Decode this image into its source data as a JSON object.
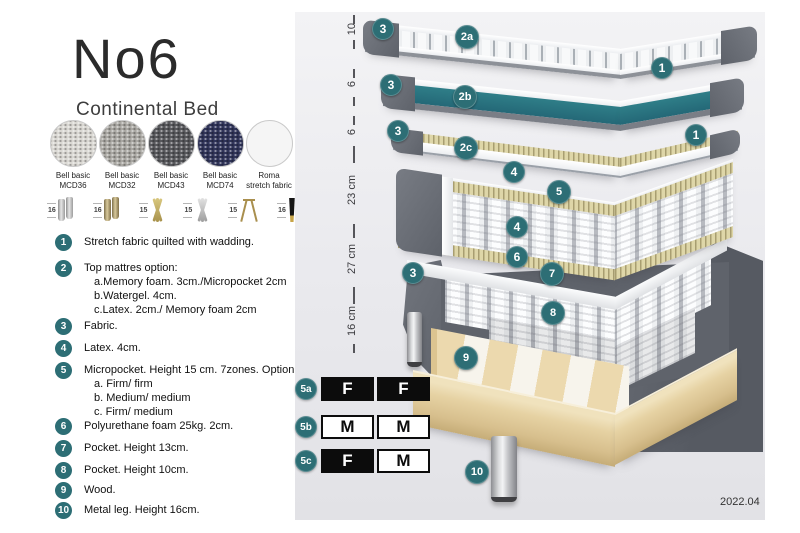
{
  "title": "No6",
  "subtitle": "Continental Bed",
  "colors": {
    "badge": "#2d6e75",
    "watergel": "#2f7e88",
    "cellblack": "#0c0c0c",
    "sw0": "#d9d7d2",
    "sw1": "#a9a7a2",
    "sw2": "#57585c",
    "sw3": "#303459",
    "sw4": "#f5f5f5"
  },
  "swatches": [
    {
      "name": "Bell basic",
      "code": "MCD36"
    },
    {
      "name": "Bell basic",
      "code": "MCD32"
    },
    {
      "name": "Bell basic",
      "code": "MCD43"
    },
    {
      "name": "Bell basic",
      "code": "MCD74"
    },
    {
      "name": "Roma",
      "code": "stretch fabric"
    }
  ],
  "legs": [
    {
      "h": "16"
    },
    {
      "h": "16"
    },
    {
      "h": "15"
    },
    {
      "h": "15"
    },
    {
      "h": "15"
    },
    {
      "h": "16"
    }
  ],
  "legend": [
    {
      "num": "1",
      "text": "Stretch fabric quilted with wadding."
    },
    {
      "num": "2",
      "text": "Top mattres option:",
      "sub": [
        "a.Memory foam. 3cm./Micropocket 2cm",
        "b.Watergel. 4cm.",
        "c.Latex. 2cm./ Memory foam 2cm"
      ]
    },
    {
      "num": "3",
      "text": "Fabric."
    },
    {
      "num": "4",
      "text": "Latex. 4cm."
    },
    {
      "num": "5",
      "text": "Micropocket. Height 15 cm. 7zones. Option:",
      "sub": [
        "a. Firm/ firm",
        "b. Medium/ medium",
        "c. Firm/ medium"
      ]
    },
    {
      "num": "6",
      "text": "Polyurethane foam 25kg. 2cm."
    },
    {
      "num": "7",
      "text": "Pocket. Height 13cm."
    },
    {
      "num": "8",
      "text": "Pocket. Height 10cm."
    },
    {
      "num": "9",
      "text": "Wood."
    },
    {
      "num": "10",
      "text": "Metal leg. Height 16cm."
    }
  ],
  "dims": [
    "10",
    "6",
    "6",
    "23 cm",
    "27 cm",
    "16 cm"
  ],
  "badges": {
    "top_3": "3",
    "l2a": "2a",
    "r1_top": "1",
    "mid_3": "3",
    "l2b": "2b",
    "low_3": "3",
    "l2c": "2c",
    "r1_bot": "1",
    "l4_top": "4",
    "l5": "5",
    "l4_bot": "4",
    "base_3": "3",
    "l6": "6",
    "l7": "7",
    "l8": "8",
    "l9": "9",
    "l10": "10"
  },
  "firmness": [
    {
      "label": "5a",
      "c0": "F",
      "c1": "F"
    },
    {
      "label": "5b",
      "c0": "M",
      "c1": "M"
    },
    {
      "label": "5c",
      "c0": "F",
      "c1": "M"
    }
  ],
  "date": "2022.04"
}
